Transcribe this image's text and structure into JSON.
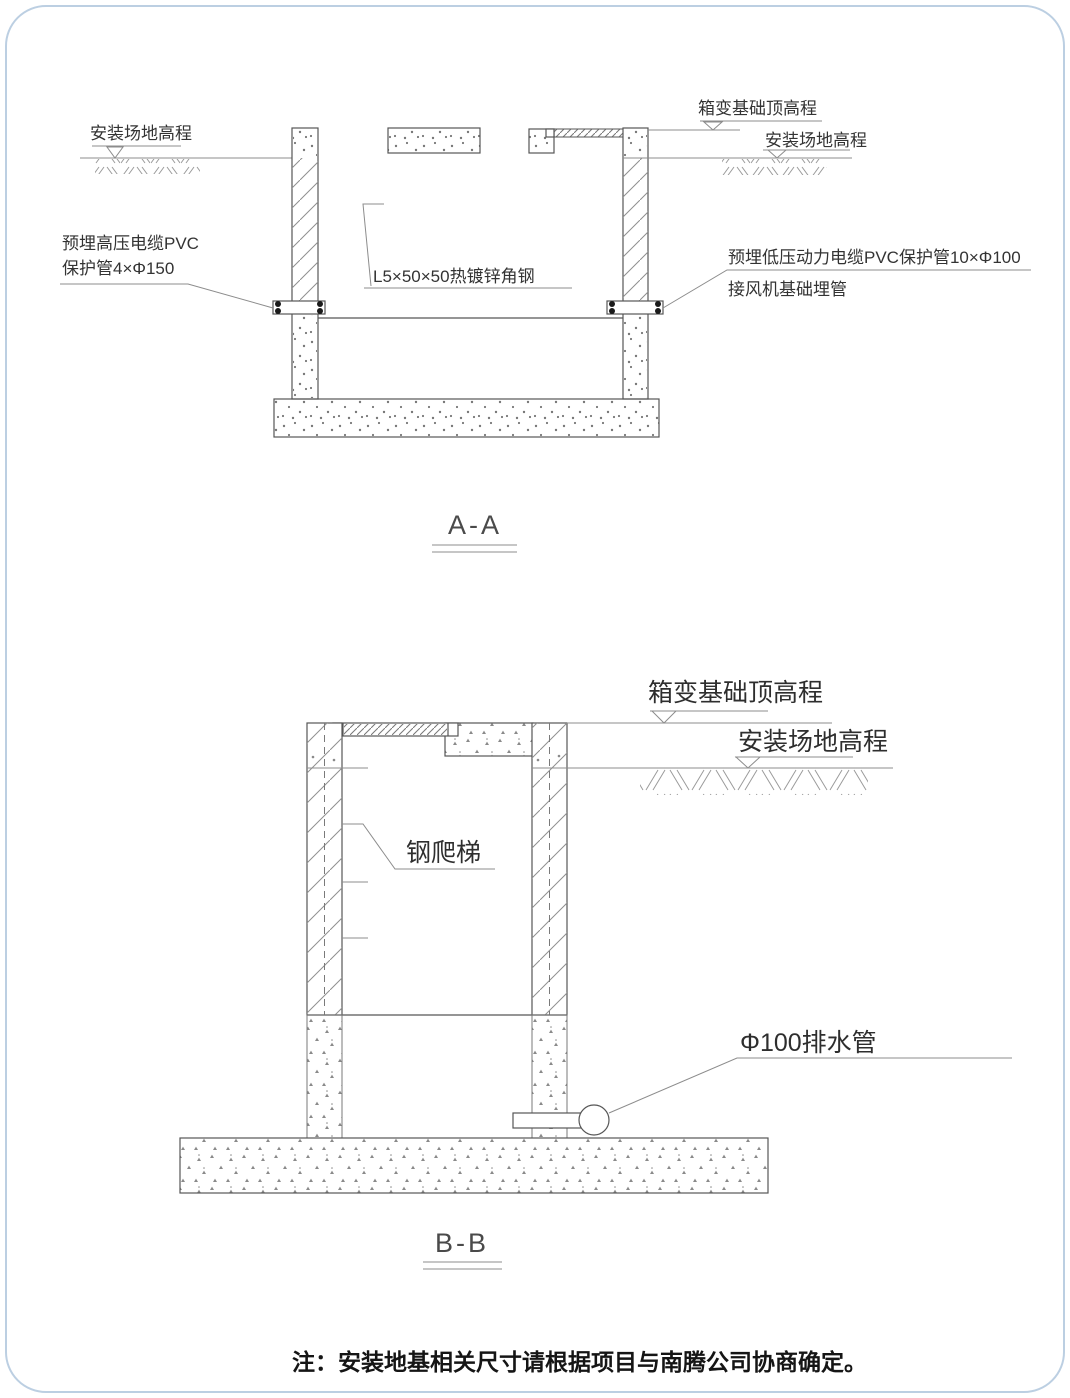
{
  "colors": {
    "border": "#bccfe2",
    "line": "#565656",
    "annotation_line": "#8c8c8c",
    "text": "#333333"
  },
  "section_aa": {
    "title": "A-A",
    "site_elevation_left": "安装场地高程",
    "hv_conduit_line1": "预埋高压电缆PVC",
    "hv_conduit_line2": "保护管4×Φ150",
    "angle_steel": "L5×50×50热镀锌角钢",
    "foundation_top": "箱变基础顶高程",
    "site_elevation_right": "安装场地高程",
    "lv_conduit_line1": "预埋低压动力电缆PVC保护管10×Φ100",
    "lv_conduit_line2": "接风机基础埋管"
  },
  "section_bb": {
    "title": "B-B",
    "foundation_top": "箱变基础顶高程",
    "site_elevation": "安装场地高程",
    "ladder": "钢爬梯",
    "drain_pipe": "Φ100排水管"
  },
  "note": "注：安装地基相关尺寸请根据项目与南腾公司协商确定。"
}
